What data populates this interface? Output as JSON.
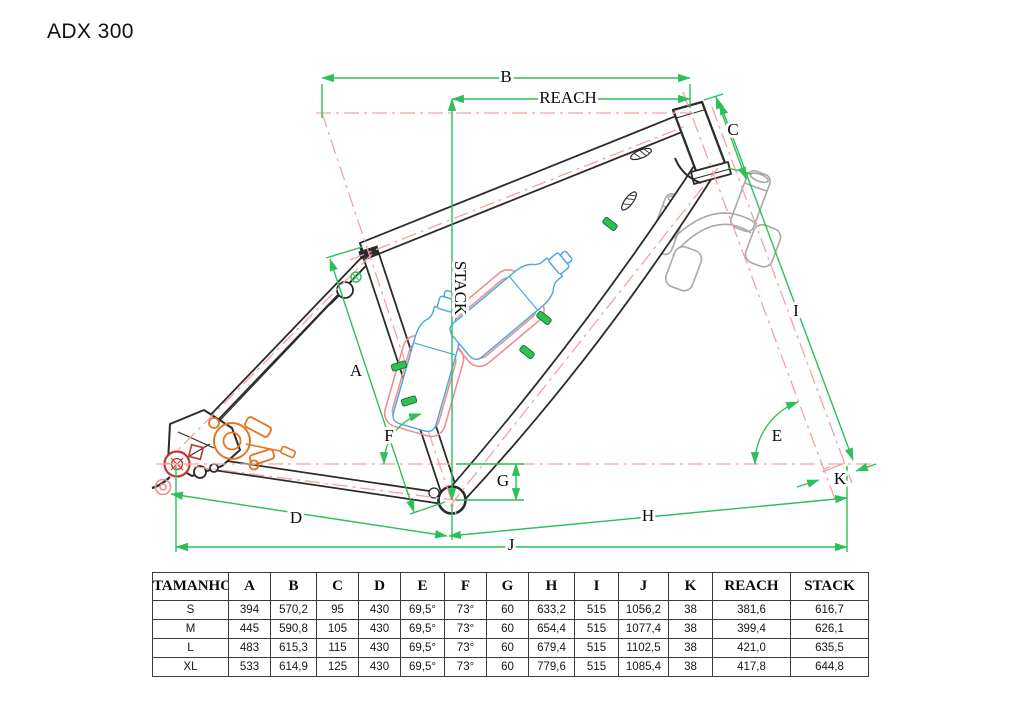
{
  "title": "ADX 300",
  "colors": {
    "dimension_green": "#2dbf58",
    "construction_pink": "#f2a3a3",
    "cage_pink": "#ef9090",
    "frame_black": "#2b2b2b",
    "bottle_blue": "#4aa8dc",
    "caliper_orange": "#e8731e",
    "hub_red": "#c0392b"
  },
  "diagram": {
    "labels": {
      "B": "B",
      "REACH": "REACH",
      "C": "C",
      "STACK": "STACK",
      "A": "A",
      "F": "F",
      "G": "G",
      "D": "D",
      "H": "H",
      "J": "J",
      "I": "I",
      "E": "E",
      "K": "K"
    }
  },
  "table": {
    "headers": [
      "TAMANHO",
      "A",
      "B",
      "C",
      "D",
      "E",
      "F",
      "G",
      "H",
      "I",
      "J",
      "K",
      "REACH",
      "STACK"
    ],
    "rows": [
      [
        "S",
        "394",
        "570,2",
        "95",
        "430",
        "69,5°",
        "73°",
        "60",
        "633,2",
        "515",
        "1056,2",
        "38",
        "381,6",
        "616,7"
      ],
      [
        "M",
        "445",
        "590,8",
        "105",
        "430",
        "69,5°",
        "73°",
        "60",
        "654,4",
        "515",
        "1077,4",
        "38",
        "399,4",
        "626,1"
      ],
      [
        "L",
        "483",
        "615,3",
        "115",
        "430",
        "69,5°",
        "73°",
        "60",
        "679,4",
        "515",
        "1102,5",
        "38",
        "421,0",
        "635,5"
      ],
      [
        "XL",
        "533",
        "614,9",
        "125",
        "430",
        "69,5°",
        "73°",
        "60",
        "779,6",
        "515",
        "1085,4",
        "38",
        "417,8",
        "644,8"
      ]
    ]
  }
}
